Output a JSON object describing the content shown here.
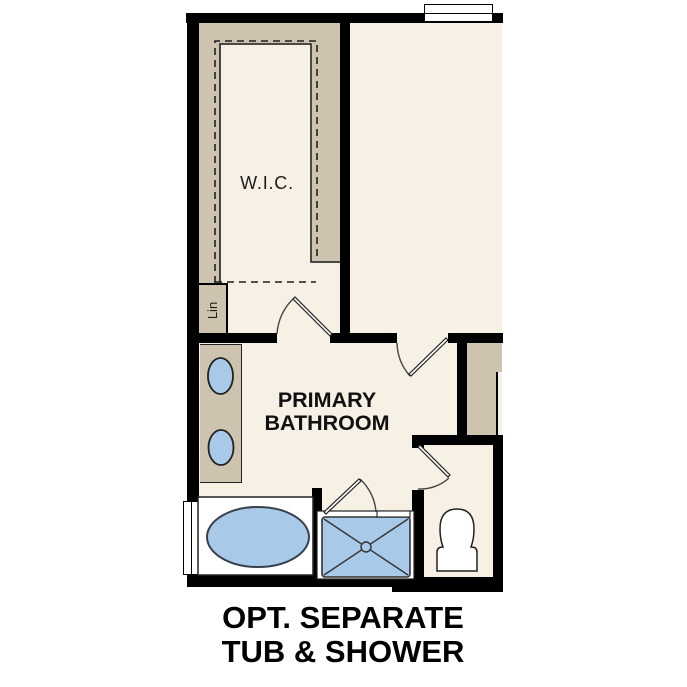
{
  "plan": {
    "rooms": {
      "wic_label": "W.I.C.",
      "linen_label": "Lin",
      "bathroom_label_line1": "PRIMARY",
      "bathroom_label_line2": "BATHROOM"
    },
    "caption": {
      "line1": "OPT. SEPARATE",
      "line2": "TUB & SHOWER"
    },
    "fixtures": {
      "tub": "oval-bathtub",
      "shower": "walk-in-shower-with-center-drain",
      "toilet": "toilet",
      "sinks": [
        "vanity-sink",
        "vanity-sink"
      ],
      "windows": [
        "window-top",
        "window-left"
      ],
      "doors": [
        "wic-door",
        "bedroom-door",
        "shower-door",
        "water-closet-door"
      ],
      "shelving": "wic-shelf-and-rod-dashed-lines"
    },
    "colors": {
      "wall": "#000000",
      "floor": "#f7f0e4",
      "cabinetry": "#cec3ae",
      "fixture_blue": "#a9c9e8",
      "text": "#111111"
    }
  }
}
